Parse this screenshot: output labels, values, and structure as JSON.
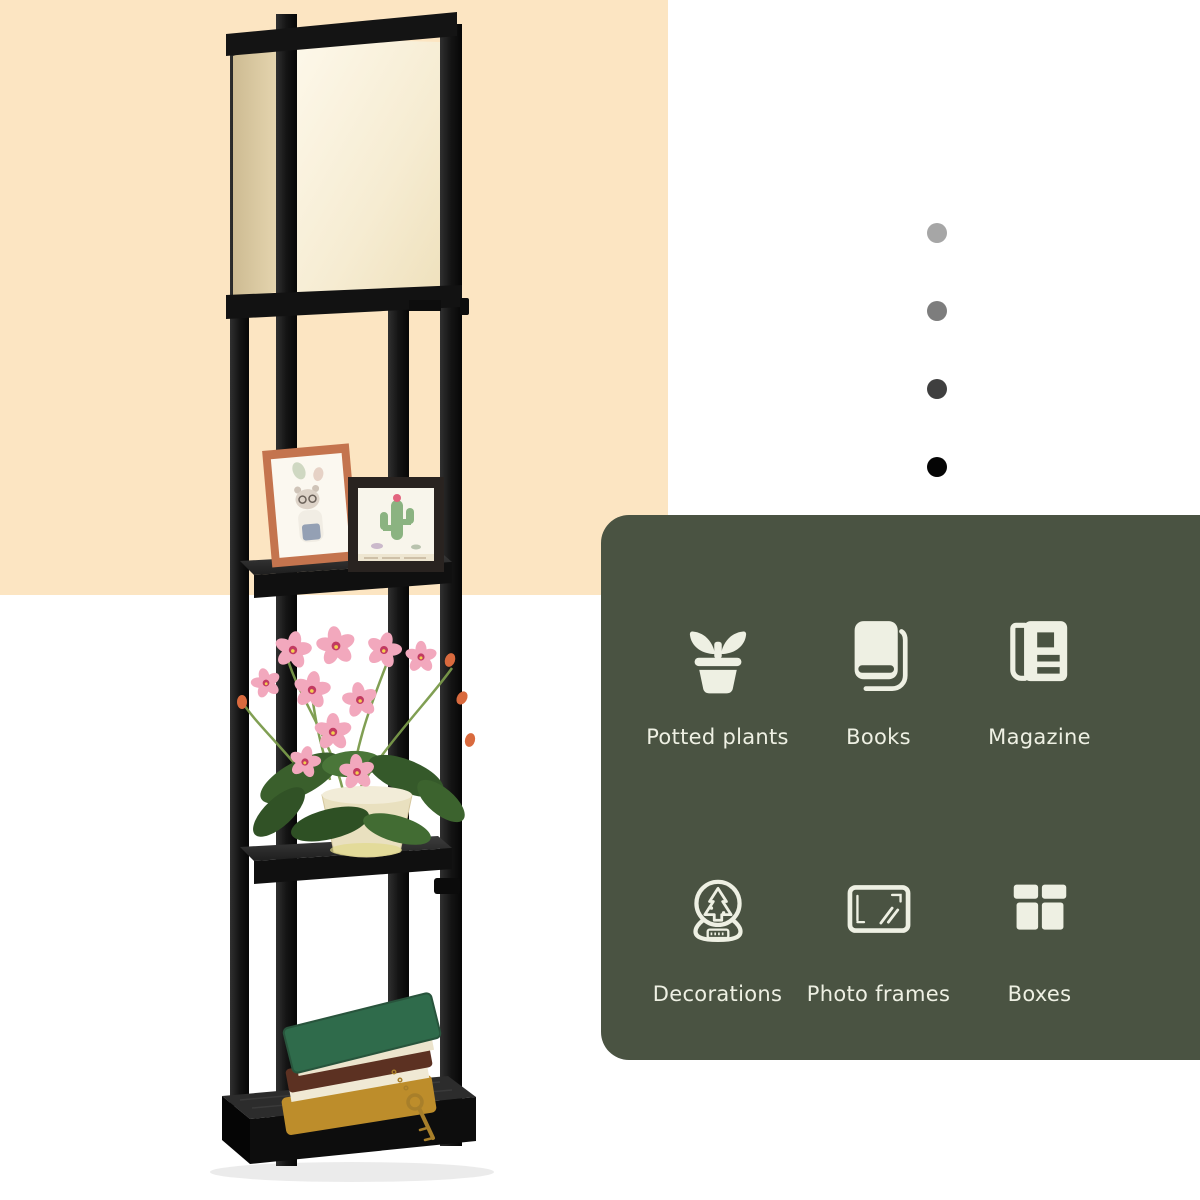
{
  "image": {
    "width": 1200,
    "height": 1200,
    "kind": "product-gallery-image"
  },
  "backdrop": {
    "peach_color": "#fce5c2",
    "white_color": "#ffffff"
  },
  "photo": {
    "subject": "black wooden etagere shelf floor lamp with beige fabric shade",
    "shelf_items": [
      "two photo frames",
      "pink orchid in cream pot",
      "stack of books with key"
    ],
    "palette": {
      "frame_black": "#141414",
      "shade_cream": "#f8f1dc",
      "shade_side_beige": "#d8c6a0",
      "copper_frame": "#c4744e",
      "dark_frame": "#292320",
      "orchid_pink": "#f2a8bd",
      "leaf_green": "#3a5f2c",
      "pot_cream": "#e9e0bf",
      "book_green": "#2f6b4b",
      "book_brown": "#5c3122",
      "book_gold": "#bd8d2b"
    }
  },
  "carousel": {
    "dots": [
      {
        "color": "#a6a6a6"
      },
      {
        "color": "#7d7d7d"
      },
      {
        "color": "#3f3f3f"
      },
      {
        "color": "#050505"
      }
    ]
  },
  "features_panel": {
    "background": "#4a5342",
    "text_color": "#eef0e3",
    "icon_color": "#f4f3ea",
    "items": [
      {
        "icon": "potted-plant-icon",
        "label": "Potted plants"
      },
      {
        "icon": "book-icon",
        "label": "Books"
      },
      {
        "icon": "magazine-icon",
        "label": "Magazine"
      },
      {
        "icon": "snow-globe-icon",
        "label": "Decorations"
      },
      {
        "icon": "photo-frame-icon",
        "label": "Photo frames"
      },
      {
        "icon": "gift-box-icon",
        "label": "Boxes"
      }
    ]
  }
}
